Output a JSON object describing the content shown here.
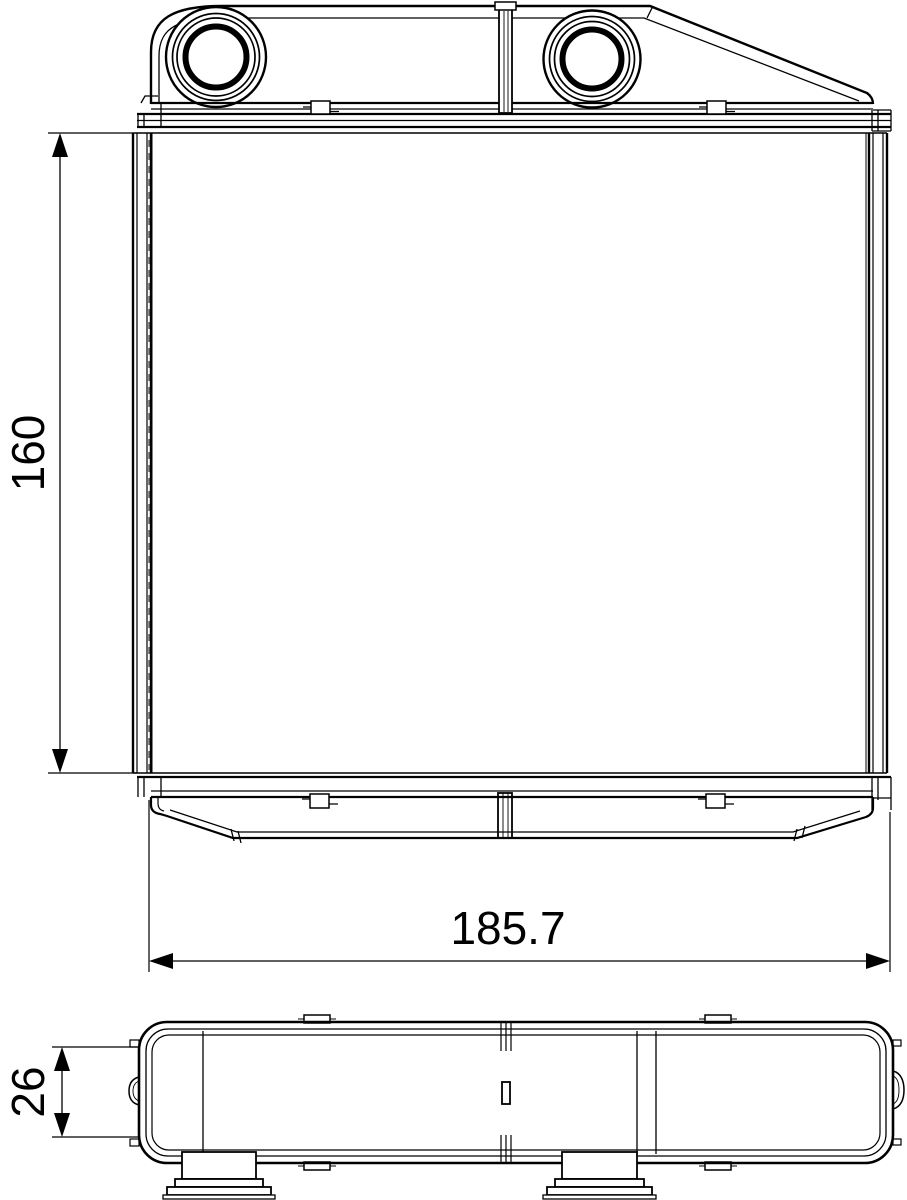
{
  "drawing": {
    "background_color": "#ffffff",
    "line_color": "#000000",
    "views": {
      "front": {
        "name": "front-view"
      },
      "side": {
        "name": "side-view"
      }
    },
    "dimensions": {
      "core_height": {
        "value": "160",
        "orientation": "vertical"
      },
      "overall_width": {
        "value": "185.7",
        "orientation": "horizontal"
      },
      "depth": {
        "value": "26",
        "orientation": "vertical"
      }
    }
  }
}
